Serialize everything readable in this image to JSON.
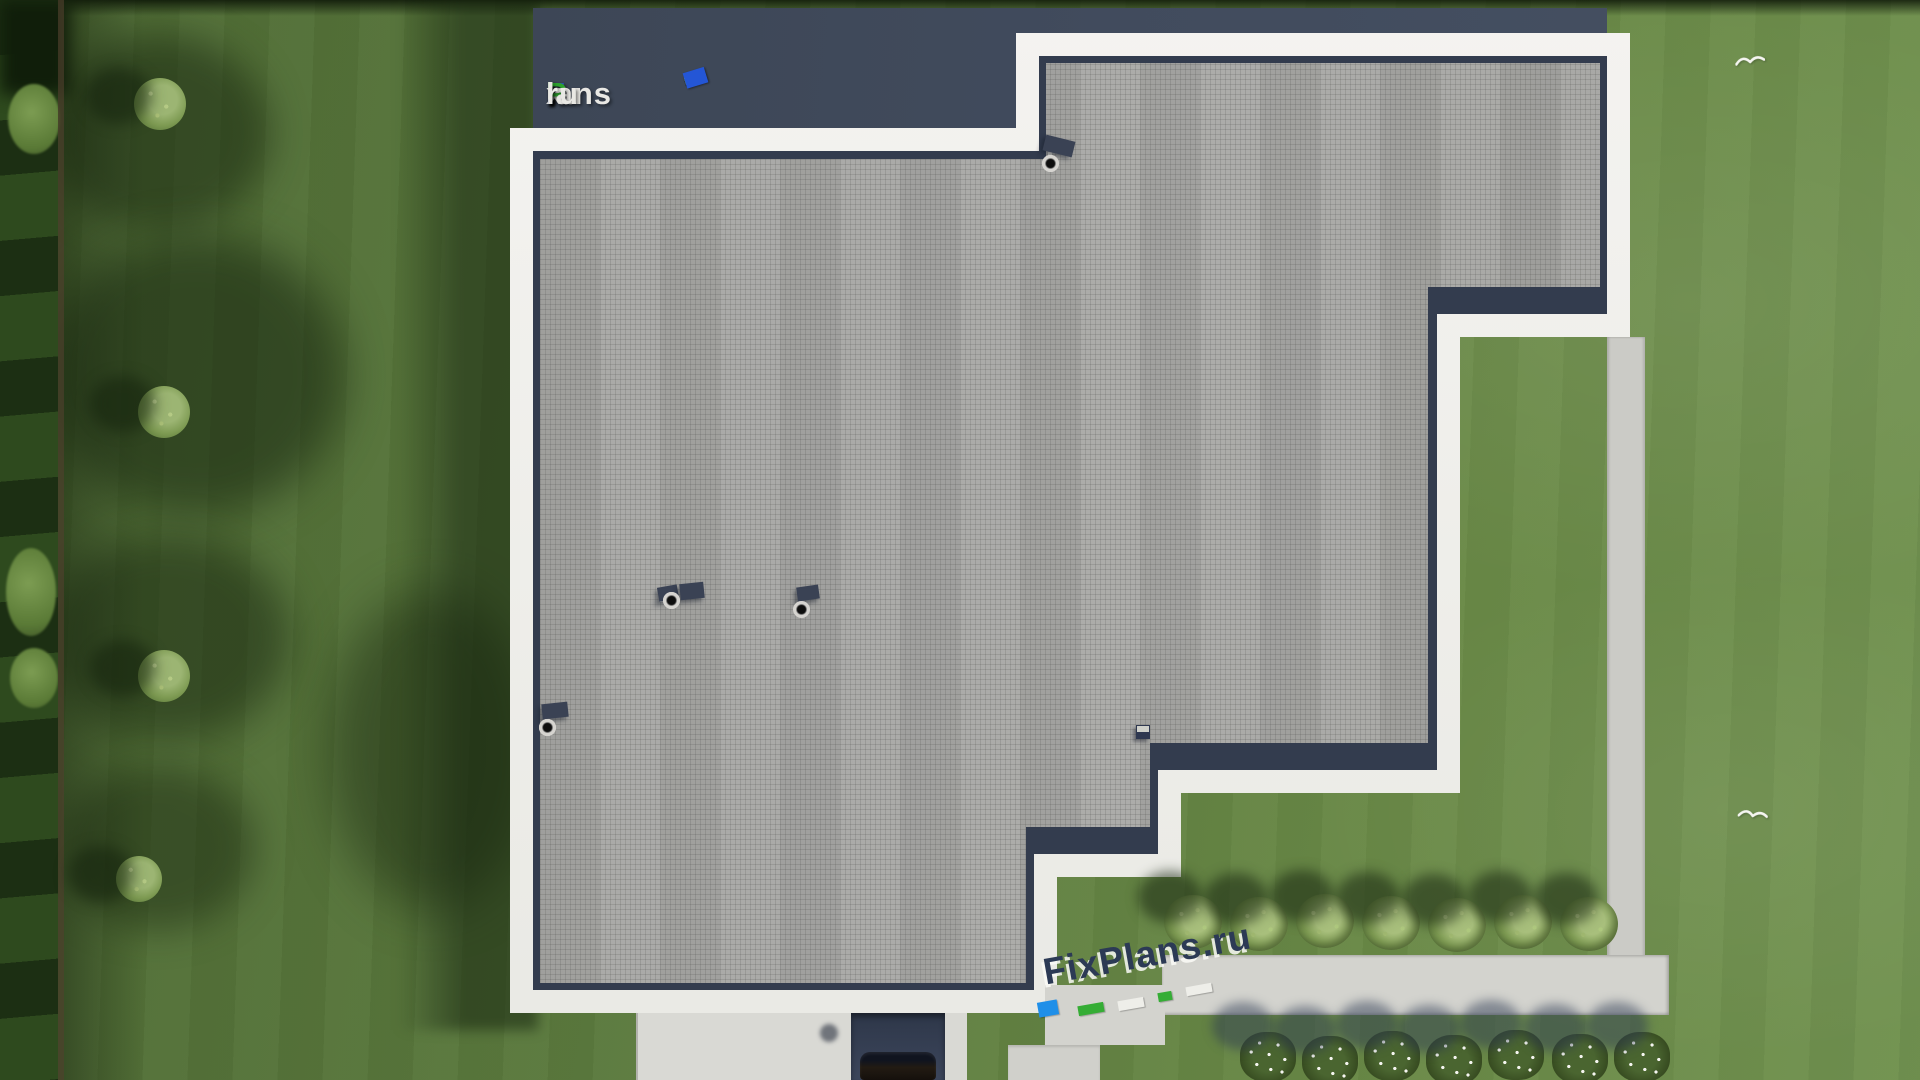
{
  "brand": "FixPlans.ru",
  "watermarks": {
    "logo": {
      "text": "FixPlans.ru",
      "segments": [
        {
          "text": "F",
          "color": "#2e54c6"
        },
        {
          "text": "i",
          "color": "#2da12d"
        },
        {
          "text": "x",
          "color": "#e9e8e4"
        },
        {
          "text": "P",
          "color": "#2da12d"
        },
        {
          "text": "lans",
          "color": "#e9e8e4"
        },
        {
          "text": ".",
          "color": "#2e54c6"
        },
        {
          "text": "ru",
          "color": "#e9e8e4"
        }
      ]
    },
    "bottom": {
      "text": "FixPlans.ru",
      "color": "#2c3a55"
    }
  },
  "scene": {
    "colors": {
      "grass": "#5d7c3f",
      "grass_light": "#719250",
      "hedge": "#253a18",
      "roof_membrane_gray": "#a4a4a1",
      "parapet_white": "#f1f1ee",
      "roof_dark_navy": "#3d4759",
      "garden_path": "#d3d3ce",
      "driveway": "#d9d9d4",
      "bush_green": "#7d9a52",
      "watermark_azure": "#1f8fe8",
      "watermark_green": "#35ad35"
    },
    "counts": {
      "left_lawn_bushes": 4,
      "right_garden_bushes": 7,
      "flower_shrubs": 7,
      "roof_vents": 5,
      "birds": 2
    }
  }
}
